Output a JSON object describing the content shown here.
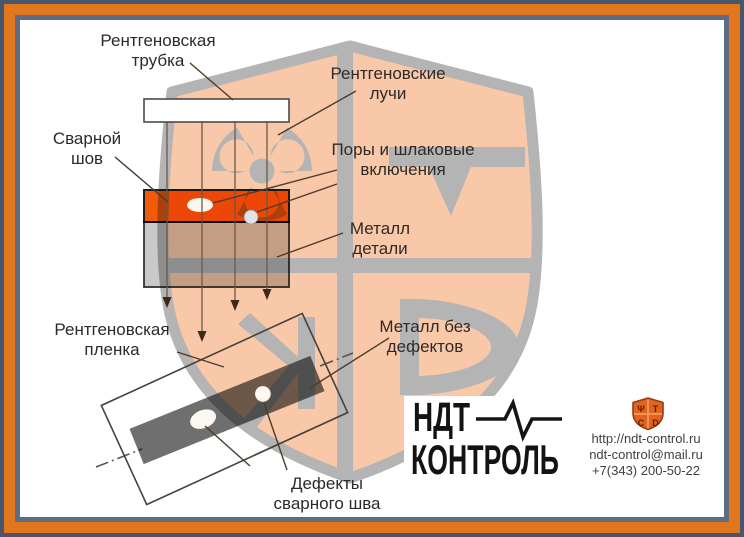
{
  "colors": {
    "frame_outer_dark": "#47566a",
    "frame_orange": "#e2761f",
    "frame_inner_slate": "#5d6e82",
    "shield_fill": "#f9c8a8",
    "shield_gray": "#b4b4b4",
    "weld_orange": "#f25a0a",
    "metal_gray": "#c9c9c9",
    "film_strip_gray": "#6f6f6f",
    "logo_black": "#131313",
    "icon_shield_orange": "#e2631f"
  },
  "diagram": {
    "labels": {
      "xray_tube": {
        "l1": "Рентгеновская",
        "l2": "трубка"
      },
      "xray_rays": {
        "l1": "Рентгеновские",
        "l2": "лучи"
      },
      "weld_seam": {
        "l1": "Сварной",
        "l2": "шов"
      },
      "pores": {
        "l1": "Поры и шлаковые",
        "l2": "включения"
      },
      "metal_part": {
        "l1": "Металл",
        "l2": "детали"
      },
      "film": {
        "l1": "Рентгеновская",
        "l2": "пленка"
      },
      "metal_no_defects": {
        "l1": "Металл без",
        "l2": "дефектов"
      },
      "weld_defects": {
        "l1": "Дефекты",
        "l2": "сварного шва"
      }
    }
  },
  "branding": {
    "logo_line1": "НДТ",
    "logo_line2": "КОНТРОЛЬ",
    "website": "http://ndt-control.ru",
    "email": "ndt-control@mail.ru",
    "phone": "+7(343) 200-50-22",
    "shield_glyphs": {
      "tl": "Ψ",
      "tr": "Т",
      "bl": "С",
      "br": "D"
    }
  }
}
